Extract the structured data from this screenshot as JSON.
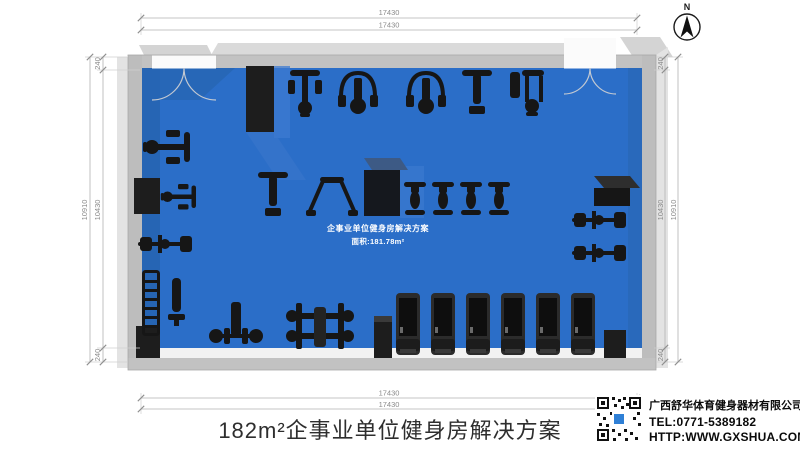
{
  "compass": {
    "label": "N"
  },
  "dimensions": {
    "top": [
      "17430",
      "17430"
    ],
    "bottom": [
      "17430",
      "17430"
    ],
    "left": {
      "outer": "10910",
      "inner": "10430",
      "offset_top": "240",
      "offset_bottom": "240"
    },
    "right": {
      "outer": "10910",
      "inner": "10430",
      "offset_top": "240",
      "offset_bottom": "240"
    }
  },
  "floor_plan": {
    "label_line1": "企事业单位健身房解决方案",
    "label_line2": "面积:181.78m²",
    "floor_color": "#2B6EC8",
    "wall_color": "#C2C2C2",
    "equipment_color": "#161616",
    "equipment_icons": [
      "lat-pulldown-machine",
      "cable-arm-machine",
      "shoulder-press-machine",
      "adjustable-bench",
      "multi-station-machine",
      "exercise-bike",
      "rowing-machine",
      "treadmill",
      "bench-press",
      "squat-rack",
      "dumbbell-rack",
      "flat-bench",
      "dip-station",
      "leg-press-machine",
      "structural-column",
      "double-door"
    ]
  },
  "footer": {
    "title": "182m²企事业单位健身房解决方案"
  },
  "company": {
    "name": "广西舒华体育健身器材有限公司",
    "tel": "TEL:0771-5389182",
    "website": "HTTP:WWW.GXSHUA.COM",
    "qr_center_color": "#2F80D6"
  }
}
